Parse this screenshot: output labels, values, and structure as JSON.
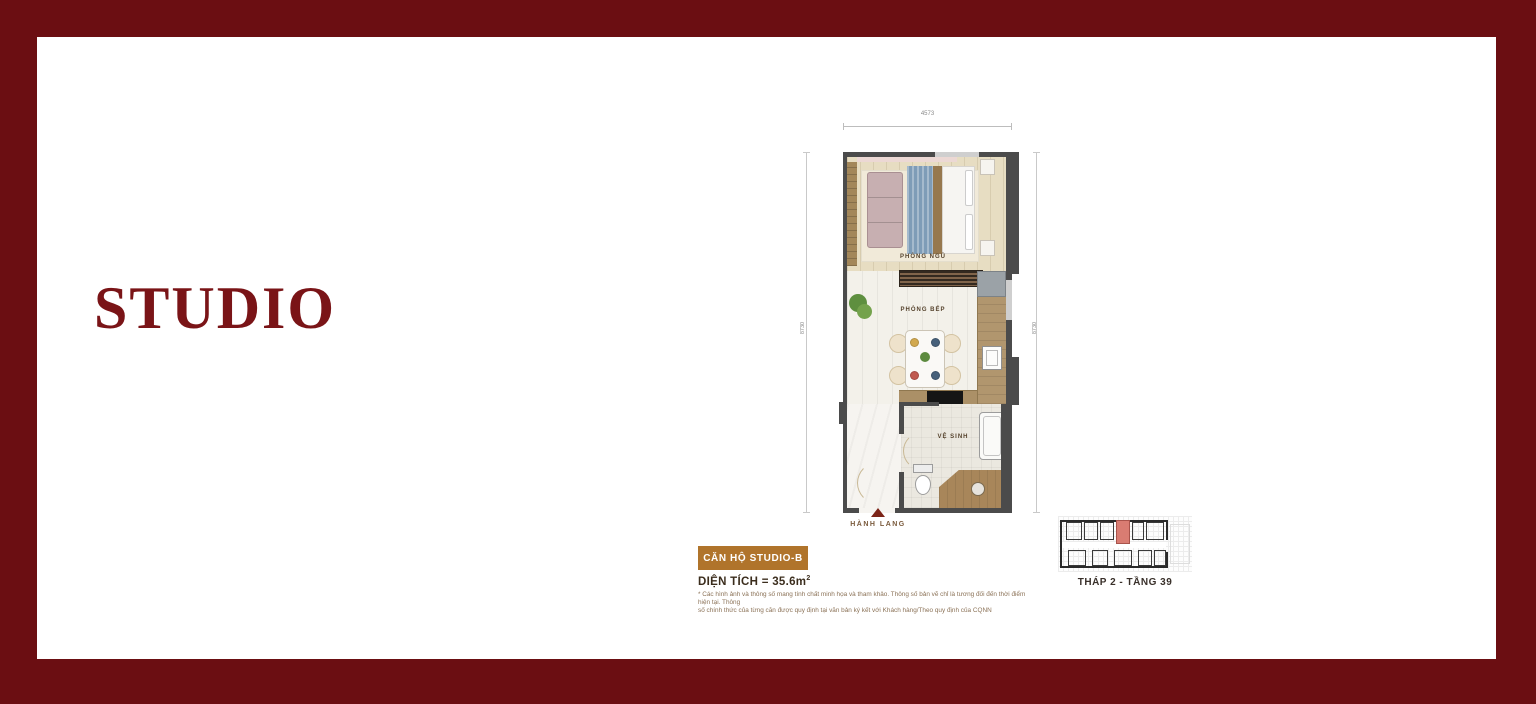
{
  "slide": {
    "title": "STUDIO"
  },
  "plan": {
    "dim_top": "4573",
    "dim_left": "8730",
    "dim_right": "8730",
    "room_bedroom": "PHÒNG NGỦ",
    "room_kitchen": "PHÒNG BẾP",
    "room_bathroom": "VỆ SINH",
    "entrance": "HÀNH LANG"
  },
  "info": {
    "badge": "CĂN HỘ STUDIO-B",
    "area_label": "DIỆN TÍCH = 35.6m",
    "area_sup": "2",
    "disclaimer_line1": "* Các hình ảnh và thông số mang tính chất minh họa và tham khảo. Thông số bản vẽ chỉ là tương đối đến thời điểm hiện tại. Thông",
    "disclaimer_line2": "số chính thức của từng căn được quy định tại văn bản ký kết với Khách hàng/Theo quy định của CQNN"
  },
  "locator": {
    "caption": "THÁP 2 - TẦNG 39",
    "highlight_color": "#D97C72"
  },
  "colors": {
    "frame_border": "#6B0E12",
    "title_text": "#7A1417",
    "badge_bg": "#B0742B",
    "wall": "#4B4B4B",
    "entrance_arrow": "#7C2418"
  }
}
